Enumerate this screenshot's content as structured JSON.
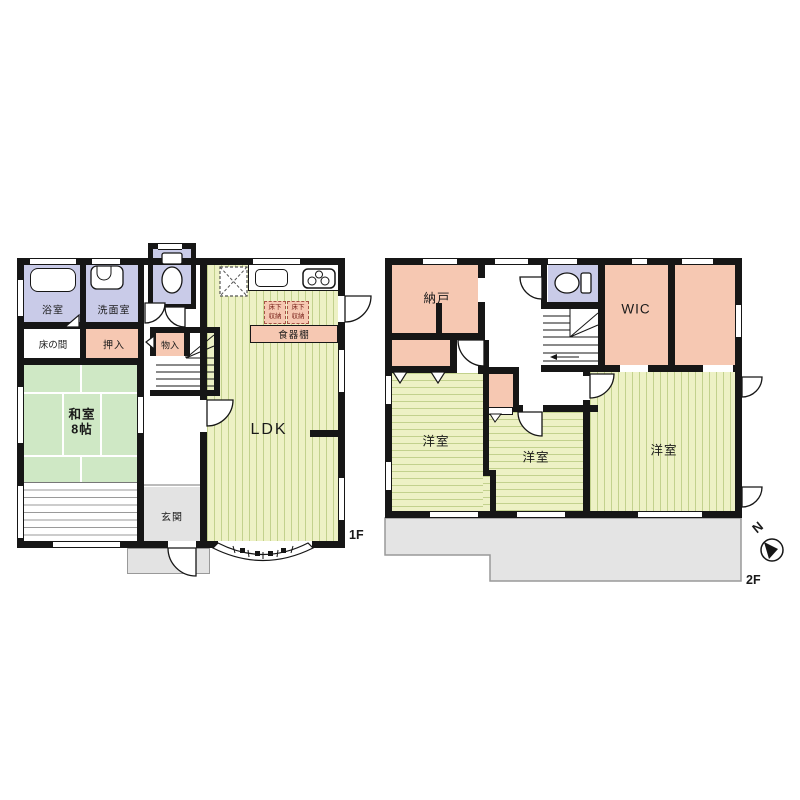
{
  "floors": {
    "f1": {
      "label": "1F",
      "bath": "浴室",
      "washroom": "洗面室",
      "tokonoma": "床の間",
      "oshiire": "押入",
      "washitsu_name": "和室",
      "washitsu_size": "8帖",
      "monoire": "物入",
      "genkan": "玄関",
      "ldk": "LDK",
      "cupboard": "食器棚",
      "underfloor_line1": "床下",
      "underfloor_line2": "収納"
    },
    "f2": {
      "label": "2F",
      "nando": "納戸",
      "wic": "WIC",
      "bedroom_left": "洋室",
      "bedroom_middle": "洋室",
      "bedroom_right": "洋室",
      "compass_north": "N"
    }
  },
  "colors": {
    "wall": "#161616",
    "wet_room_purple": "#c9cbe8",
    "closet_pink": "#f6c8b2",
    "tatami_green": "#cfe8c5",
    "flooring_yellow_green": "#edf1c5",
    "flooring_stripe": "#c2d18d",
    "entrance_gray": "#e3e3e3"
  }
}
